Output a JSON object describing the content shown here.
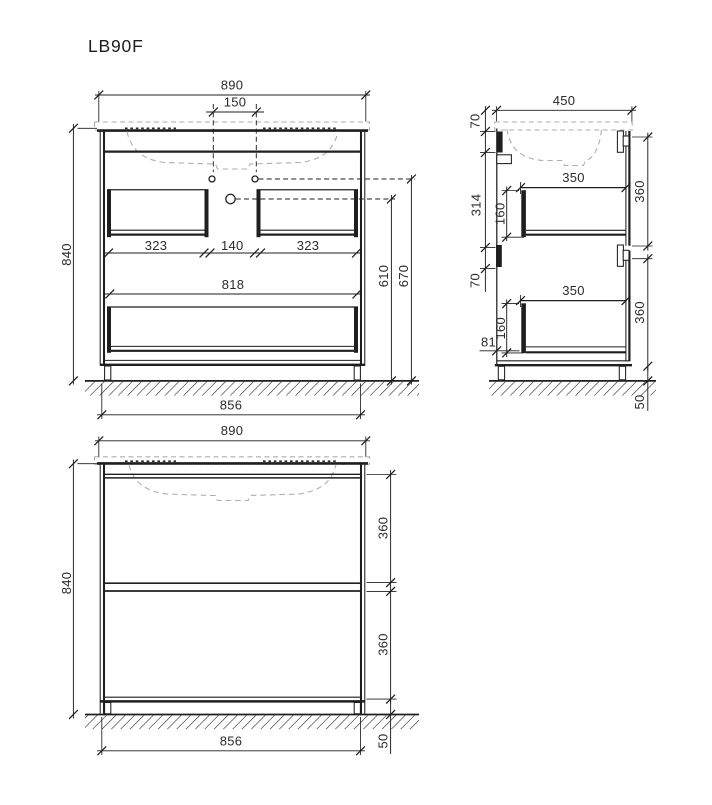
{
  "title": "LB90F",
  "front_view": {
    "width": "890",
    "faucet_spacing": "150",
    "height": "840",
    "left_drawer": "323",
    "center_gap": "140",
    "right_drawer": "323",
    "inner_width": "818",
    "drain_height": "610",
    "faucet_height": "670",
    "base_width": "856"
  },
  "side_view": {
    "depth": "450",
    "top_offset": "70",
    "back_spacing": "314",
    "mid_offset": "70",
    "top_drawer_depth": "350",
    "top_drawer_height": "160",
    "top_front_height": "360",
    "bottom_drawer_depth": "350",
    "bottom_drawer_height": "160",
    "bottom_front_height": "360",
    "bottom_offset": "81",
    "leg_height": "50"
  },
  "closed_view": {
    "width": "890",
    "height": "840",
    "top_front_height": "360",
    "bottom_front_height": "360",
    "base_width": "856",
    "leg_height": "50"
  },
  "colors": {
    "line": "#1f1f1f",
    "light_gray": "#aeaeae",
    "text": "#2b2b2b"
  }
}
